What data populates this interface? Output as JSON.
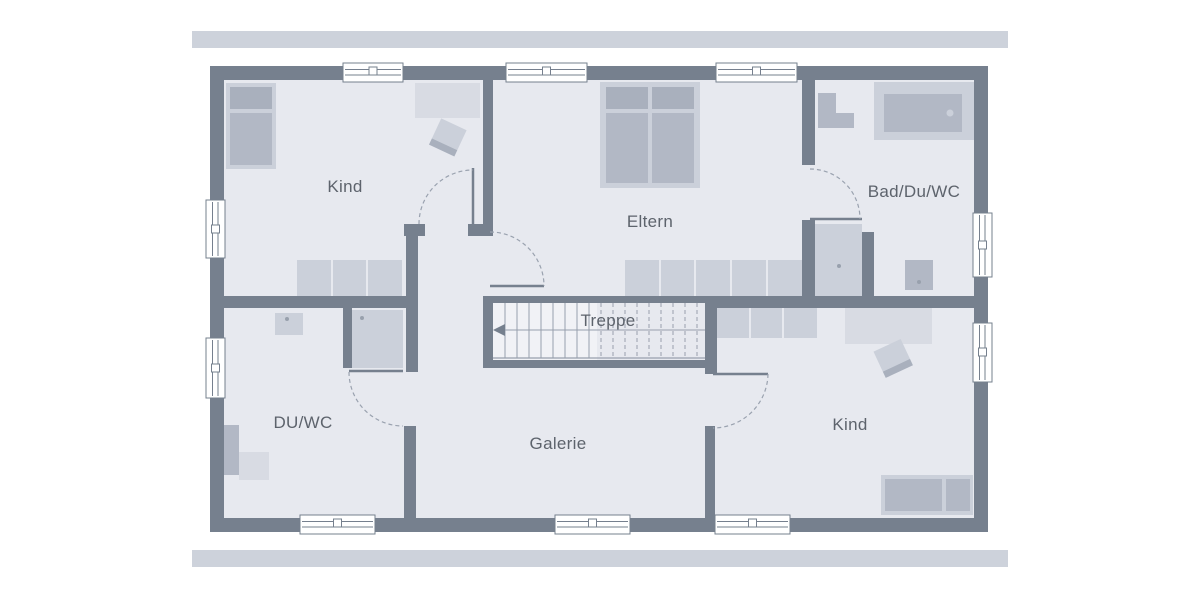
{
  "plan": {
    "type": "floor-plan-upper-storey",
    "labels": {
      "kind_top_left": "Kind",
      "eltern": "Eltern",
      "bad_du_wc": "Bad/Du/WC",
      "treppe": "Treppe",
      "du_wc": "DU/WC",
      "galerie": "Galerie",
      "kind_bottom_right": "Kind"
    }
  },
  "icons": {
    "stairs_direction_arrow": "triangle-pointing-left",
    "window_symbol": "double-line-with-handle-square",
    "door_symbol": "leaf-line-with-dashed-quarter-arc"
  },
  "colors": {
    "page_bg": "#FFFFFF",
    "wall": "#76808E",
    "floor": "#E7E9EF",
    "floor_light": "#F1F2F6",
    "band": "#CDD2DB",
    "furn": "#CBD0DA",
    "furn_dark": "#B2B8C5",
    "furn_darker": "#A9B0BD",
    "furn_light": "#D8DBE3",
    "line": "#98A0AD",
    "arc": "#9AA2AF",
    "label": "#5D636C"
  }
}
